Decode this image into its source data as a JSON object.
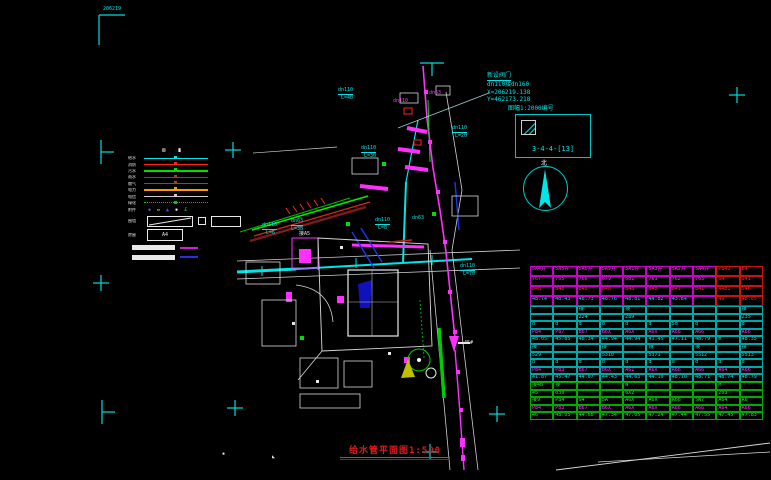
{
  "colors": {
    "cy": "#00e5e5",
    "mg": "#ff30ff",
    "wh": "#e8e8e8",
    "gr": "#00dd00",
    "rd": "#ff2222",
    "bl": "#3344ff"
  },
  "annotations": {
    "valve_line1": "新设阀门",
    "valve_line2": "dn110接dn160",
    "valve_line3": "X=206219.138",
    "valve_line4": "Y=462173.218",
    "sheet_note": "图幅1:2000编号",
    "detail_box_label": "3-4-4-[13]",
    "north_label": "北",
    "title": "给水管平面图1:500"
  },
  "legend": {
    "header_glyphs": [
      "⊠",
      "∎"
    ],
    "rows": [
      {
        "label": "给水",
        "color": "#00e5e5",
        "style": "solid"
      },
      {
        "label": "消防",
        "color": "#ff2020",
        "style": "solid"
      },
      {
        "label": "污水",
        "color": "#00dd00",
        "style": "solid"
      },
      {
        "label": "雨水",
        "color": "#b03030",
        "style": "solid"
      },
      {
        "label": "燃气",
        "color": "#a04020",
        "style": "solid"
      },
      {
        "label": "电力",
        "color": "#ff9900",
        "style": "solid"
      },
      {
        "label": "电信",
        "color": "#cccccc",
        "style": "solid"
      },
      {
        "label": "绿化",
        "color": "#00cc00",
        "style": "dotted"
      }
    ],
    "symbols_label": "附件",
    "symbols": [
      {
        "glyph": "◆",
        "color": "#5050ff"
      },
      {
        "glyph": "▭",
        "color": "#ffffff"
      },
      {
        "glyph": "▲",
        "color": "#5050ff"
      },
      {
        "glyph": "▪",
        "color": "#ffffff"
      },
      {
        "glyph": "£",
        "color": "#00dd00"
      }
    ],
    "diag_label": "围墙",
    "a4_label": "房屋",
    "a4_text": "A4"
  },
  "map_labels": [
    {
      "t": "dn110",
      "x": 452,
      "y": 126,
      "c": "cy",
      "u": 1
    },
    {
      "t": "L=20",
      "x": 455,
      "y": 134,
      "c": "cy"
    },
    {
      "t": "dn110",
      "x": 361,
      "y": 146,
      "c": "cy",
      "u": 1
    },
    {
      "t": "L=30",
      "x": 364,
      "y": 154,
      "c": "cy"
    },
    {
      "t": "dn110",
      "x": 338,
      "y": 88,
      "c": "cy",
      "u": 1
    },
    {
      "t": "L=40",
      "x": 341,
      "y": 96,
      "c": "cy"
    },
    {
      "t": "dn63",
      "x": 291,
      "y": 219,
      "c": "cy",
      "u": 1
    },
    {
      "t": "L=38",
      "x": 291,
      "y": 227,
      "c": "cy"
    },
    {
      "t": "dn110",
      "x": 262,
      "y": 223,
      "c": "cy",
      "u": 1
    },
    {
      "t": "L=6",
      "x": 266,
      "y": 231,
      "c": "cy"
    },
    {
      "t": "dn110",
      "x": 375,
      "y": 218,
      "c": "cy",
      "u": 1
    },
    {
      "t": "L=8",
      "x": 378,
      "y": 226,
      "c": "cy"
    },
    {
      "t": "dn63",
      "x": 412,
      "y": 216,
      "c": "cy"
    },
    {
      "t": "dn110",
      "x": 460,
      "y": 264,
      "c": "cy",
      "u": 1
    },
    {
      "t": "L=70",
      "x": 463,
      "y": 272,
      "c": "cy"
    },
    {
      "t": "接A5",
      "x": 299,
      "y": 232,
      "c": "wh"
    },
    {
      "t": "dn110",
      "x": 393,
      "y": 99,
      "c": "mg"
    },
    {
      "t": "dn63",
      "x": 429,
      "y": 91,
      "c": "mg"
    },
    {
      "t": "45#",
      "x": 464,
      "y": 341,
      "c": "wh"
    },
    {
      "t": "206219",
      "x": 103,
      "y": 7,
      "c": "cy"
    },
    {
      "t": "▪",
      "x": 222,
      "y": 452,
      "c": "wh"
    },
    {
      "t": "◣",
      "x": 272,
      "y": 455,
      "c": "wh"
    }
  ],
  "crosshairs": [
    {
      "t": "corner",
      "x": 99,
      "y": 15
    },
    {
      "t": "tdown",
      "x": 432,
      "y": 63
    },
    {
      "t": "plus",
      "x": 737,
      "y": 95
    },
    {
      "t": "tright",
      "x": 101,
      "y": 152
    },
    {
      "t": "plus",
      "x": 233,
      "y": 150
    },
    {
      "t": "plus",
      "x": 101,
      "y": 283
    },
    {
      "t": "tright",
      "x": 102,
      "y": 412
    },
    {
      "t": "plus",
      "x": 235,
      "y": 408
    },
    {
      "t": "plus",
      "x": 430,
      "y": 452
    },
    {
      "t": "plus",
      "x": 497,
      "y": 414
    }
  ],
  "table": {
    "x": 530,
    "y": 266,
    "w": 233,
    "rows": [
      {
        "h": 10,
        "b": "m",
        "b2": "r",
        "t": "m",
        "t2": "r",
        "cells": [
          "5A4井",
          "5A5井",
          "5A6井",
          "5A9井",
          "5A1井",
          "5A3井",
          "5A2井",
          "5A4井",
          "P842",
          "B4"
        ]
      },
      {
        "h": 10,
        "b": "m",
        "b2": "r",
        "t": "m",
        "t2": "r",
        "cells": [
          "767",
          "765",
          "766",
          "679",
          "681",
          "761",
          "762",
          "763",
          "64",
          "241"
        ]
      },
      {
        "h": 10,
        "b": "m",
        "b2": "r",
        "t": "r",
        "t2": "r",
        "cells": [
          "848",
          "848",
          "848",
          "848",
          "848",
          "848",
          "841",
          "841",
          "A4B1",
          "546"
        ]
      },
      {
        "h": 10,
        "b": "m",
        "b2": "r",
        "t": "c",
        "t2": "r",
        "cells": [
          "48.74",
          "48.43",
          "48.73",
          "48.76",
          "48.81",
          "44.82",
          "43.84",
          "",
          "49",
          "48.05"
        ]
      },
      {
        "h": 7.6,
        "b": "c",
        "t": "c",
        "cells": [
          "",
          "",
          "接",
          "",
          "接",
          "",
          "",
          "",
          "",
          "接"
        ]
      },
      {
        "h": 7.6,
        "b": "c",
        "t": "c",
        "cells": [
          "",
          "",
          "224",
          "",
          "289",
          "",
          "",
          "",
          "",
          "235"
        ]
      },
      {
        "h": 7.6,
        "b": "c",
        "t": "c",
        "cells": [
          "d",
          "d",
          "d",
          "d",
          "d",
          "d",
          "5d",
          "d",
          "",
          "d"
        ]
      },
      {
        "h": 7.6,
        "b": "c",
        "t": "m",
        "cells": [
          "P84",
          "P87",
          "B67",
          "B6X",
          "A6X",
          "A6X",
          "A66",
          "A66",
          "",
          "A66"
        ]
      },
      {
        "h": 7.6,
        "b": "c",
        "t": "c",
        "cells": [
          "48.05",
          "45.85",
          "48.34",
          "44.94",
          "44.94",
          "41.45",
          "47.11",
          "48.79",
          "m",
          "48.35"
        ]
      },
      {
        "h": 7.6,
        "b": "c",
        "t": "c",
        "cells": [
          "接",
          "",
          "",
          "接",
          "",
          "接",
          "",
          "接",
          "",
          "接"
        ]
      },
      {
        "h": 7.6,
        "b": "c",
        "t": "c",
        "cells": [
          "529",
          "",
          "",
          "5310",
          "",
          "5371",
          "",
          "5512",
          "",
          "5513"
        ]
      },
      {
        "h": 7.6,
        "b": "c",
        "t": "c",
        "cells": [
          "d",
          "d",
          "d",
          "d",
          "d",
          "d",
          "d",
          "d",
          "d",
          "d"
        ]
      },
      {
        "h": 7.6,
        "b": "c",
        "t": "m",
        "cells": [
          "P84",
          "P83",
          "B67",
          "B6X",
          "A61",
          "A6X",
          "A66",
          "A66",
          "A64",
          "A66"
        ]
      },
      {
        "h": 7.6,
        "b": "c",
        "t": "c",
        "cells": [
          "41.87",
          "45.47",
          "44.07",
          "44.43",
          "44.63",
          "44.10",
          "48.10",
          "48.71",
          "48.74",
          "48.79"
        ]
      },
      {
        "h": 7.6,
        "b": "g",
        "t": "g",
        "cells": [
          "接4B",
          "接",
          "",
          "",
          "W",
          "",
          "",
          "",
          "M",
          ""
        ]
      },
      {
        "h": 7.6,
        "b": "g",
        "t": "g",
        "cells": [
          "45",
          "030",
          "",
          "",
          "6X2",
          "",
          "",
          "",
          "203",
          ""
        ]
      },
      {
        "h": 7.6,
        "b": "g",
        "t": "g",
        "cells": [
          "接9",
          "P84",
          "94",
          "5A",
          "A6X",
          "A6X",
          "A66",
          "5W7",
          "A64",
          "A6"
        ]
      },
      {
        "h": 7.6,
        "b": "g",
        "t": "m",
        "cells": [
          "P84",
          "P83",
          "B67",
          "B6X",
          "A6X",
          "A6X",
          "A66",
          "A66",
          "A64",
          "A66"
        ]
      },
      {
        "h": 7.6,
        "b": "g",
        "t": "g",
        "cells": [
          "46",
          "48.05",
          "44.68",
          "47.34",
          "47.05",
          "47.24",
          "47.44",
          "47.55",
          "47.45",
          "47.83"
        ]
      }
    ],
    "palette": {
      "m": "#cc00cc",
      "r": "#cc1111",
      "c": "#00a8a8",
      "g": "#00aa00"
    },
    "text_palette": {
      "m": "#ff30ff",
      "r": "#ff2222",
      "c": "#00e5e5",
      "g": "#22ee22"
    }
  }
}
